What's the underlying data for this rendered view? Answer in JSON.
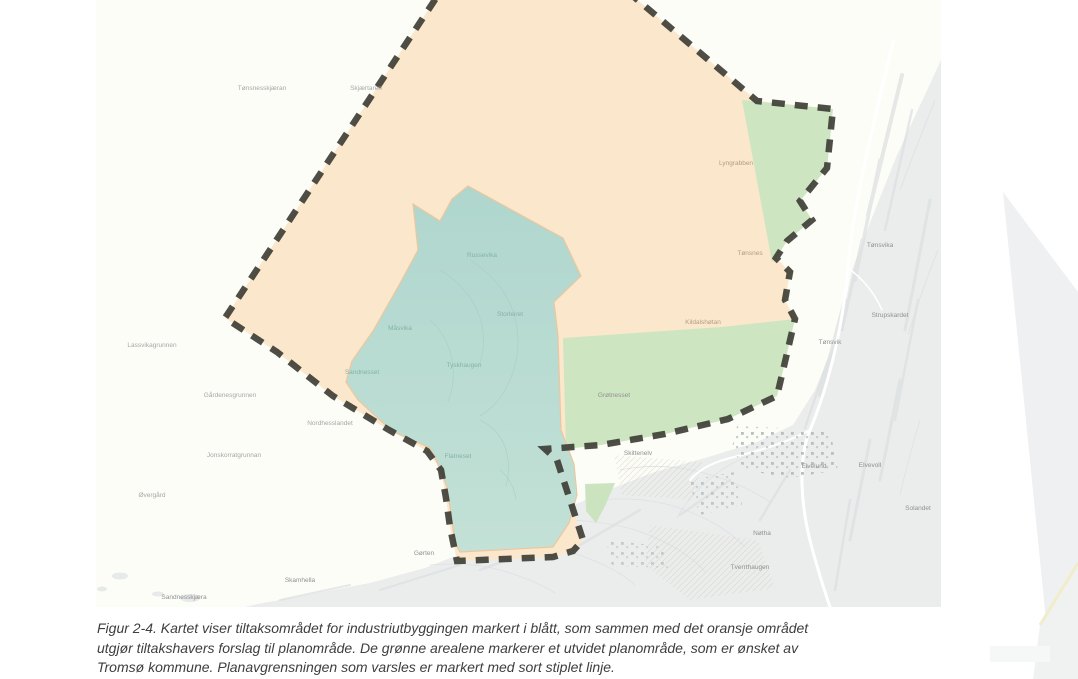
{
  "figure_caption": {
    "lines": [
      "Figur 2-4. Kartet viser tiltaksområdet for industriutbyggingen markert i blått, som sammen med det oransje området",
      "utgjør tiltakshavers forslag til planområde. De grønne arealene markerer et utvidet planområde, som er ønsket av",
      "Tromsø kommune. Planavgrensningen som varsles er markert med sort stiplet linje."
    ],
    "full_text": "Figur 2-4. Kartet viser tiltaksområdet for industriutbyggingen markert i blått, som sammen med det oransje området utgjør tiltakshavers forslag til planområde. De grønne arealene markerer et utvidet planområde, som er ønsket av Tromsø kommune. Planavgrensningen som varsles er markert med sort stiplet linje."
  },
  "map": {
    "colors": {
      "sea": "#fdfdf8",
      "terrain": "#ebeded",
      "proposal_area_orange": "#fbe7cb",
      "industrial_area_blue": "#b2d8d0",
      "municipal_extension_green": "#cee5c1",
      "plan_boundary_dash": "#3b3b33",
      "shore_accent": "#ecc79e"
    },
    "areas": [
      {
        "name": "tiltaksomrade-industri",
        "color": "#b2d8d0"
      },
      {
        "name": "tiltakshavers-planomrade",
        "color": "#fbe7cb"
      },
      {
        "name": "utvidet-planomrade-kommune",
        "color": "#cee5c1"
      },
      {
        "name": "planavgrensning-varslet",
        "color": "#3b3b33"
      }
    ],
    "labels": [
      {
        "text": "Tønsnesskjæran",
        "x": 262,
        "y": 90,
        "tone": "sea"
      },
      {
        "text": "Skjærtaren",
        "x": 366,
        "y": 90,
        "tone": "sea"
      },
      {
        "text": "Lyngrabben",
        "x": 736,
        "y": 165,
        "tone": "warm"
      },
      {
        "text": "Tønsnes",
        "x": 750,
        "y": 255,
        "tone": "warm"
      },
      {
        "text": "Kildalshøtan",
        "x": 703,
        "y": 324,
        "tone": "warm"
      },
      {
        "text": "Russevika",
        "x": 482,
        "y": 257,
        "tone": "teal"
      },
      {
        "text": "Storleiret",
        "x": 510,
        "y": 316,
        "tone": "teal"
      },
      {
        "text": "Måsvika",
        "x": 400,
        "y": 330,
        "tone": "teal"
      },
      {
        "text": "Sandnesset",
        "x": 362,
        "y": 374,
        "tone": "teal"
      },
      {
        "text": "Tyskhaugen",
        "x": 464,
        "y": 367,
        "tone": "teal"
      },
      {
        "text": "Flatneset",
        "x": 458,
        "y": 458,
        "tone": "teal"
      },
      {
        "text": "Lassvikagrunnen",
        "x": 152,
        "y": 347,
        "tone": "sea"
      },
      {
        "text": "Gårdenesgrunnen",
        "x": 230,
        "y": 397,
        "tone": "sea"
      },
      {
        "text": "Jonskorratgrunnan",
        "x": 234,
        "y": 457,
        "tone": "sea"
      },
      {
        "text": "Nordhesslandet",
        "x": 330,
        "y": 425,
        "tone": "sea"
      },
      {
        "text": "Øvergård",
        "x": 152,
        "y": 497,
        "tone": "sea"
      },
      {
        "text": "Grøtnesset",
        "x": 614,
        "y": 397,
        "tone": "land"
      },
      {
        "text": "Skittenelv",
        "x": 638,
        "y": 455,
        "tone": "land"
      },
      {
        "text": "Nøtha",
        "x": 762,
        "y": 535,
        "tone": "land"
      },
      {
        "text": "Tverrthaugen",
        "x": 750,
        "y": 569,
        "tone": "land"
      },
      {
        "text": "Gørten",
        "x": 424,
        "y": 555,
        "tone": "land"
      },
      {
        "text": "Tønsvika",
        "x": 880,
        "y": 247,
        "tone": "land"
      },
      {
        "text": "Strupskardet",
        "x": 890,
        "y": 317,
        "tone": "land"
      },
      {
        "text": "Tønsvik",
        "x": 830,
        "y": 344,
        "tone": "land"
      },
      {
        "text": "Sandnesskjæra",
        "x": 184,
        "y": 599,
        "tone": "land"
      },
      {
        "text": "Skamhella",
        "x": 300,
        "y": 582,
        "tone": "land"
      },
      {
        "text": "Elvelund",
        "x": 814,
        "y": 468,
        "tone": "land"
      },
      {
        "text": "Elvevoll",
        "x": 870,
        "y": 467,
        "tone": "land"
      },
      {
        "text": "Solandet",
        "x": 918,
        "y": 510,
        "tone": "land"
      }
    ]
  }
}
